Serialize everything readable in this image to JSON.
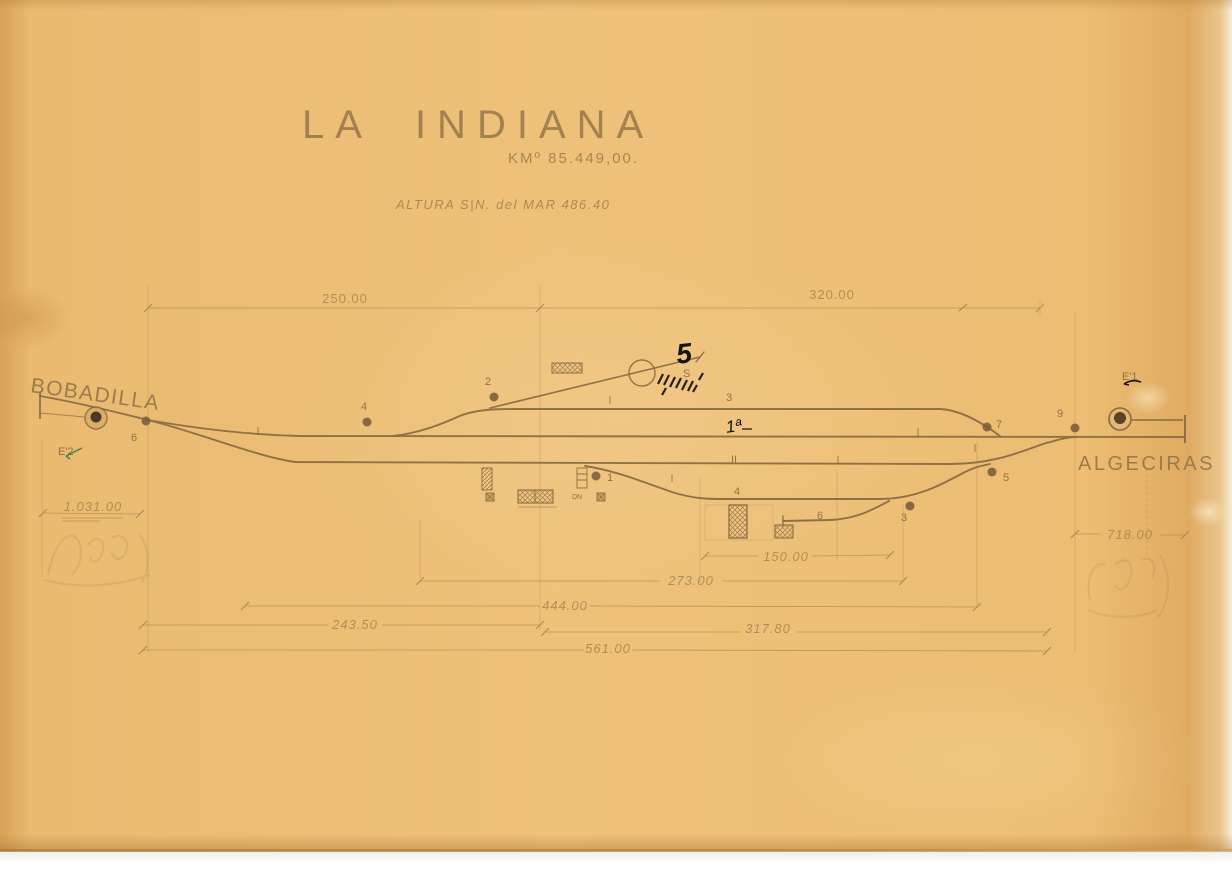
{
  "colors": {
    "paper": "#edbf76",
    "line_brown": "#8a6a42",
    "pencil": "#a8854f",
    "ink_black": "#16150f",
    "green_mark": "#3c7a4a"
  },
  "header": {
    "title": "LA  INDIANA",
    "km": "KMº 85.449,00.",
    "altitude": "ALTURA S|N. del MAR 486.40"
  },
  "endpoints": {
    "left": "BOBADILLA",
    "right": "ALGECIRAS"
  },
  "signals": {
    "left": "E'2",
    "right": "E'1"
  },
  "tracks": {
    "track3": "3",
    "main": "1ª",
    "loop": "II",
    "track4": "4",
    "siding6": "6"
  },
  "switch_labels": {
    "s1": "1",
    "s2": "2",
    "s3": "3",
    "s4": "4",
    "s5": "5",
    "s6": "6",
    "s7": "7",
    "s9": "9"
  },
  "annotations": {
    "ink_number": "5",
    "spur_letter": "S",
    "building_code": "DN"
  },
  "dimensions": {
    "top_left": "250.00",
    "top_right": "320.00",
    "left_distance": "1.031.00",
    "siding": "150.00",
    "d273": "273.00",
    "d444": "444.00",
    "d243": "243.50",
    "d317": "317.80",
    "d561": "561.00",
    "right_distance": "718.00"
  }
}
